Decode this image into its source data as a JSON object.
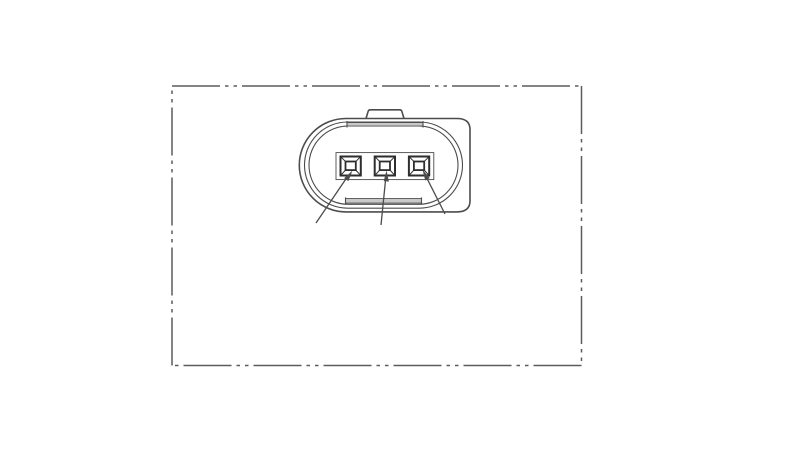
{
  "drawing": {
    "type": "technical-drawing",
    "subject": "oval 3-pin electrical connector, face view, inside phantom-line reference rectangle",
    "pin_count": 3,
    "visible_text": "",
    "colors": {
      "background": "#ffffff",
      "line": "#4c4c4c",
      "bold_line": "#2e2e2e",
      "phantom_line": "#5c5c5c",
      "shade": "#c9c9c9"
    }
  }
}
